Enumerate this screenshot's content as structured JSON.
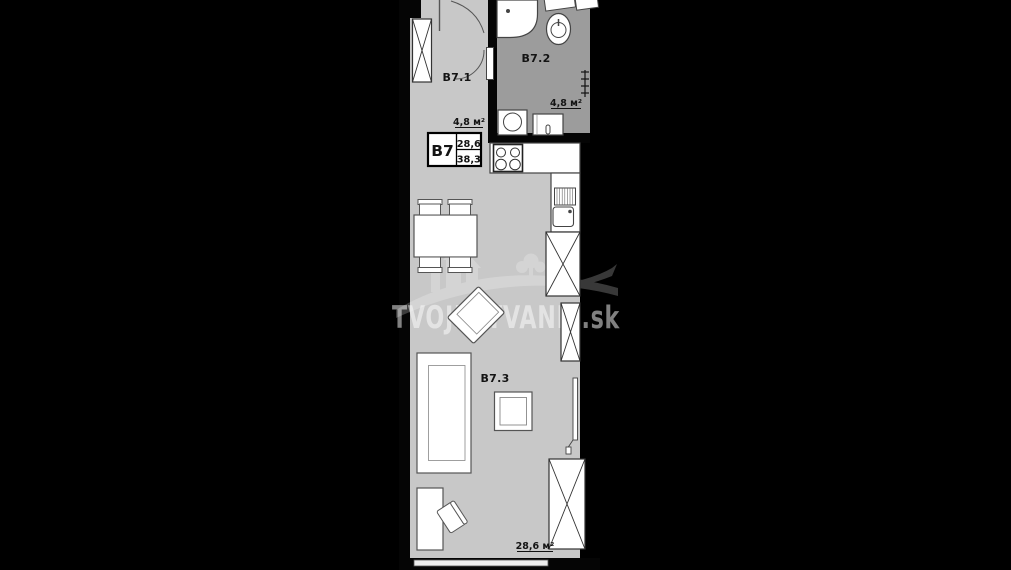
{
  "floorplan": {
    "unit": "B7",
    "info_box": {
      "unit_label": "B7",
      "value_top": "28,6",
      "value_bottom": "38,3"
    },
    "rooms": {
      "hallway": {
        "label": "B7.1",
        "area": "4,8 м²"
      },
      "bathroom": {
        "label": "B7.2",
        "area": "4,8 м²"
      },
      "living_room": {
        "label": "B7.3",
        "area": "28,6 м²"
      }
    },
    "watermark": "TVOJEBYVANIE.sk",
    "colors": {
      "background": "#000000",
      "floor_main": "#c8c8c8",
      "floor_bathroom": "#9c9c9c",
      "walls": "#000000",
      "furniture_fill": "#ffffff",
      "furniture_outline": "#444444"
    }
  }
}
